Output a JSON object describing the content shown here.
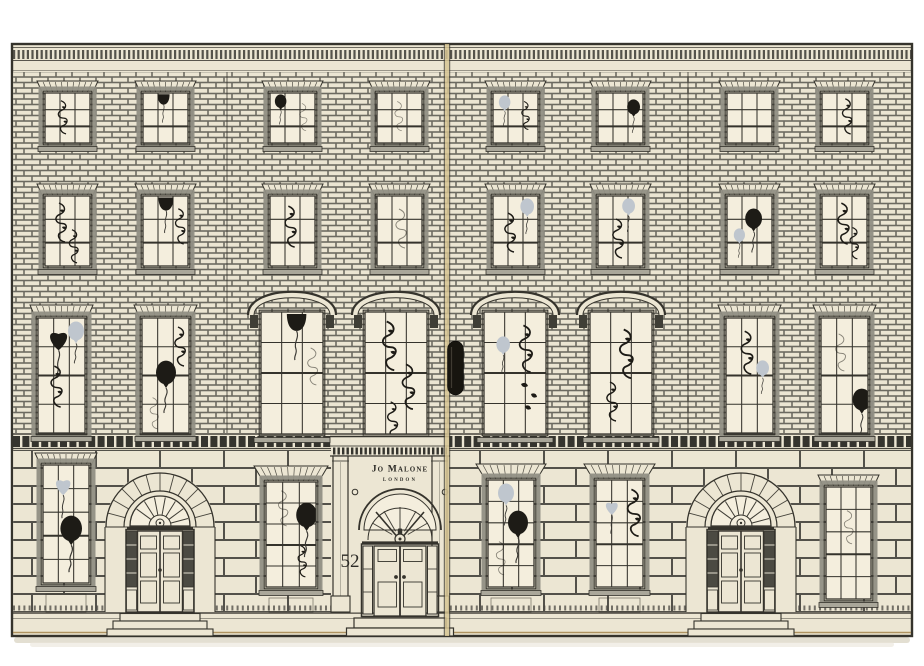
{
  "scene": {
    "type": "product-photo",
    "description": "Cream advent-calendar box illustrated as a Georgian townhouse facade, two hinged panels with a central clasp, windows decorated with balloons and ribbons"
  },
  "sign": {
    "brand": "Jo Malone",
    "city": "LONDON"
  },
  "door": {
    "number": "52"
  },
  "palette": {
    "background": "#ffffff",
    "cream": "#ece6d3",
    "pane": "#f4eedd",
    "ink": "#35332c",
    "frame_gray": "#918f84",
    "silver": "#bfc6ce",
    "black": "#1d1b16",
    "gold_seam": "#d6c493",
    "shadow": "#d7d1bf"
  },
  "doors": [
    {
      "id": "left-door",
      "cx": 160
    },
    {
      "id": "center-door",
      "cx": 400
    },
    {
      "id": "right-door",
      "cx": 741
    }
  ],
  "windows": [
    {
      "id": "attic-1",
      "x": 45,
      "y": 93,
      "w": 45,
      "h": 50,
      "cols": 3,
      "rows": 3,
      "lintel": 12,
      "deco": [
        [
          "ribbon",
          10,
          6,
          0.85
        ]
      ]
    },
    {
      "id": "attic-2",
      "x": 143,
      "y": 93,
      "w": 45,
      "h": 50,
      "cols": 3,
      "rows": 3,
      "lintel": 12,
      "deco": [
        [
          "hanging-balloon",
          11,
          0,
          0.8
        ]
      ]
    },
    {
      "id": "attic-3",
      "x": 270,
      "y": 93,
      "w": 45,
      "h": 50,
      "cols": 3,
      "rows": 3,
      "lintel": 12,
      "deco": [
        [
          "black-balloon",
          2,
          1,
          0.72
        ],
        [
          "faint-ribbon",
          27,
          9,
          0.7
        ]
      ]
    },
    {
      "id": "attic-4",
      "x": 377,
      "y": 93,
      "w": 45,
      "h": 50,
      "cols": 3,
      "rows": 3,
      "lintel": 12,
      "deco": [
        [
          "faint-ribbon",
          15,
          7,
          0.75
        ]
      ]
    },
    {
      "id": "attic-5",
      "x": 493,
      "y": 93,
      "w": 45,
      "h": 50,
      "cols": 3,
      "rows": 3,
      "lintel": 12,
      "deco": [
        [
          "silver-balloon",
          3,
          2,
          0.72
        ],
        [
          "ribbon",
          26,
          7,
          0.72
        ]
      ]
    },
    {
      "id": "attic-6",
      "x": 598,
      "y": 93,
      "w": 45,
      "h": 50,
      "cols": 3,
      "rows": 3,
      "lintel": 12,
      "deco": [
        [
          "black-balloon",
          26,
          6,
          0.8
        ]
      ]
    },
    {
      "id": "attic-7",
      "x": 727,
      "y": 93,
      "w": 45,
      "h": 50,
      "cols": 3,
      "rows": 3,
      "lintel": 12,
      "deco": []
    },
    {
      "id": "attic-8",
      "x": 822,
      "y": 93,
      "w": 45,
      "h": 50,
      "cols": 3,
      "rows": 3,
      "lintel": 12,
      "deco": [
        [
          "ribbon",
          17,
          4,
          0.9
        ]
      ]
    },
    {
      "id": "second-1",
      "x": 45,
      "y": 196,
      "w": 45,
      "h": 70,
      "cols": 3,
      "rows": 3,
      "lintel": 12,
      "deco": [
        [
          "ribbon",
          7,
          5,
          1.0
        ],
        [
          "ribbon",
          21,
          32,
          0.85
        ]
      ]
    },
    {
      "id": "second-2",
      "x": 143,
      "y": 196,
      "w": 45,
      "h": 70,
      "cols": 3,
      "rows": 3,
      "lintel": 12,
      "deco": [
        [
          "hanging-balloon",
          11,
          0,
          1.0
        ],
        [
          "ribbon",
          29,
          11,
          0.9
        ]
      ]
    },
    {
      "id": "second-3",
      "x": 270,
      "y": 196,
      "w": 45,
      "h": 70,
      "cols": 3,
      "rows": 3,
      "lintel": 12,
      "deco": [
        [
          "ribbon",
          11,
          8,
          1.05
        ]
      ]
    },
    {
      "id": "second-4",
      "x": 377,
      "y": 196,
      "w": 45,
      "h": 70,
      "cols": 3,
      "rows": 3,
      "lintel": 12,
      "deco": [
        [
          "faint-ribbon",
          15,
          11,
          1.0
        ]
      ]
    },
    {
      "id": "second-5",
      "x": 493,
      "y": 196,
      "w": 45,
      "h": 70,
      "cols": 3,
      "rows": 3,
      "lintel": 12,
      "deco": [
        [
          "silver-balloon",
          24,
          2,
          0.85
        ],
        [
          "ribbon",
          8,
          15,
          1.0
        ]
      ]
    },
    {
      "id": "second-6",
      "x": 598,
      "y": 196,
      "w": 45,
      "h": 70,
      "cols": 3,
      "rows": 3,
      "lintel": 12,
      "deco": [
        [
          "silver-balloon",
          21,
          2,
          0.8
        ],
        [
          "ribbon",
          11,
          21,
          1.0
        ]
      ]
    },
    {
      "id": "second-7",
      "x": 727,
      "y": 196,
      "w": 45,
      "h": 70,
      "cols": 3,
      "rows": 3,
      "lintel": 12,
      "deco": [
        [
          "black-balloon",
          14,
          12,
          1.05
        ],
        [
          "silver-balloon",
          4,
          32,
          0.7
        ]
      ]
    },
    {
      "id": "second-8",
      "x": 822,
      "y": 196,
      "w": 45,
      "h": 70,
      "cols": 3,
      "rows": 3,
      "lintel": 12,
      "deco": [
        [
          "ribbon",
          12,
          5,
          1.05
        ],
        [
          "ribbon",
          25,
          30,
          0.8
        ]
      ]
    },
    {
      "id": "piano-1",
      "x": 38,
      "y": 318,
      "w": 47,
      "h": 115,
      "cols": 3,
      "rows": 4,
      "lintel": 13,
      "deco": [
        [
          "black-heart",
          5,
          5,
          1.3
        ],
        [
          "silver-balloon",
          26,
          3,
          1.0
        ],
        [
          "ribbon",
          9,
          46,
          1.05
        ]
      ]
    },
    {
      "id": "piano-2",
      "x": 142,
      "y": 318,
      "w": 47,
      "h": 115,
      "cols": 3,
      "rows": 4,
      "lintel": 13,
      "deco": [
        [
          "ribbon",
          29,
          7,
          1.0
        ],
        [
          "black-balloon",
          9,
          42,
          1.25
        ],
        [
          "faint-ribbon",
          5,
          78,
          0.8
        ]
      ]
    },
    {
      "id": "piano-7",
      "x": 726,
      "y": 318,
      "w": 47,
      "h": 115,
      "cols": 3,
      "rows": 4,
      "lintel": 13,
      "deco": [
        [
          "ribbon",
          11,
          11,
          1.1
        ],
        [
          "silver-balloon",
          27,
          42,
          0.8
        ]
      ]
    },
    {
      "id": "piano-8",
      "x": 821,
      "y": 318,
      "w": 47,
      "h": 115,
      "cols": 3,
      "rows": 4,
      "lintel": 13,
      "deco": [
        [
          "faint-ribbon",
          11,
          14,
          0.95
        ],
        [
          "black-balloon",
          27,
          70,
          1.15
        ]
      ]
    },
    {
      "id": "piano-arch-1",
      "x": 261,
      "y": 312,
      "w": 62,
      "h": 122,
      "cols": 3,
      "rows": 4,
      "arched": true,
      "deco": [
        [
          "hanging-balloon",
          20,
          0,
          1.3
        ],
        [
          "faint-ribbon",
          43,
          34,
          0.95
        ]
      ]
    },
    {
      "id": "piano-arch-2",
      "x": 365,
      "y": 312,
      "w": 62,
      "h": 122,
      "cols": 3,
      "rows": 4,
      "arched": true,
      "deco": [
        [
          "ribbon",
          13,
          7,
          1.25
        ],
        [
          "ribbon",
          33,
          50,
          1.15
        ],
        [
          "ribbon",
          19,
          88,
          0.95
        ]
      ]
    },
    {
      "id": "piano-arch-3",
      "x": 484,
      "y": 312,
      "w": 62,
      "h": 122,
      "cols": 3,
      "rows": 4,
      "arched": true,
      "deco": [
        [
          "silver-balloon",
          9,
          24,
          0.85
        ],
        [
          "ribbon",
          31,
          11,
          1.2
        ],
        [
          "confetti",
          33,
          68,
          1.0
        ]
      ]
    },
    {
      "id": "piano-arch-4",
      "x": 590,
      "y": 312,
      "w": 62,
      "h": 122,
      "cols": 3,
      "rows": 4,
      "arched": true,
      "deco": [
        [
          "ribbon",
          25,
          15,
          1.25
        ],
        [
          "ribbon",
          13,
          68,
          1.0
        ]
      ]
    },
    {
      "id": "ground-1",
      "x": 43,
      "y": 465,
      "w": 46,
      "h": 118,
      "cols": 3,
      "rows": 5,
      "lintel": 12,
      "deco": [
        [
          "silver-heart",
          7,
          7,
          1.1
        ],
        [
          "black-balloon",
          12,
          50,
          1.35
        ]
      ]
    },
    {
      "id": "ground-2",
      "x": 266,
      "y": 482,
      "w": 50,
      "h": 105,
      "cols": 3,
      "rows": 5,
      "lintel": 16,
      "deco": [
        [
          "faint-ribbon",
          9,
          7,
          0.9
        ],
        [
          "black-balloon",
          25,
          20,
          1.3
        ],
        [
          "ribbon",
          29,
          62,
          0.8
        ]
      ]
    },
    {
      "id": "ground-3",
      "x": 488,
      "y": 480,
      "w": 46,
      "h": 107,
      "cols": 3,
      "rows": 5,
      "lintel": 16,
      "deco": [
        [
          "silver-balloon",
          6,
          3,
          1.0
        ],
        [
          "black-balloon",
          15,
          30,
          1.25
        ],
        [
          "faint-ribbon",
          5,
          60,
          0.85
        ]
      ]
    },
    {
      "id": "ground-4",
      "x": 596,
      "y": 480,
      "w": 47,
      "h": 107,
      "cols": 3,
      "rows": 5,
      "lintel": 16,
      "deco": [
        [
          "silver-heart",
          5,
          16,
          0.9
        ],
        [
          "ribbon",
          27,
          7,
          1.2
        ]
      ]
    },
    {
      "id": "ground-5",
      "x": 826,
      "y": 487,
      "w": 45,
      "h": 112,
      "cols": 3,
      "rows": 5,
      "lintel": 12,
      "deco": [
        [
          "faint-ribbon",
          15,
          22,
          0.85
        ]
      ]
    }
  ]
}
